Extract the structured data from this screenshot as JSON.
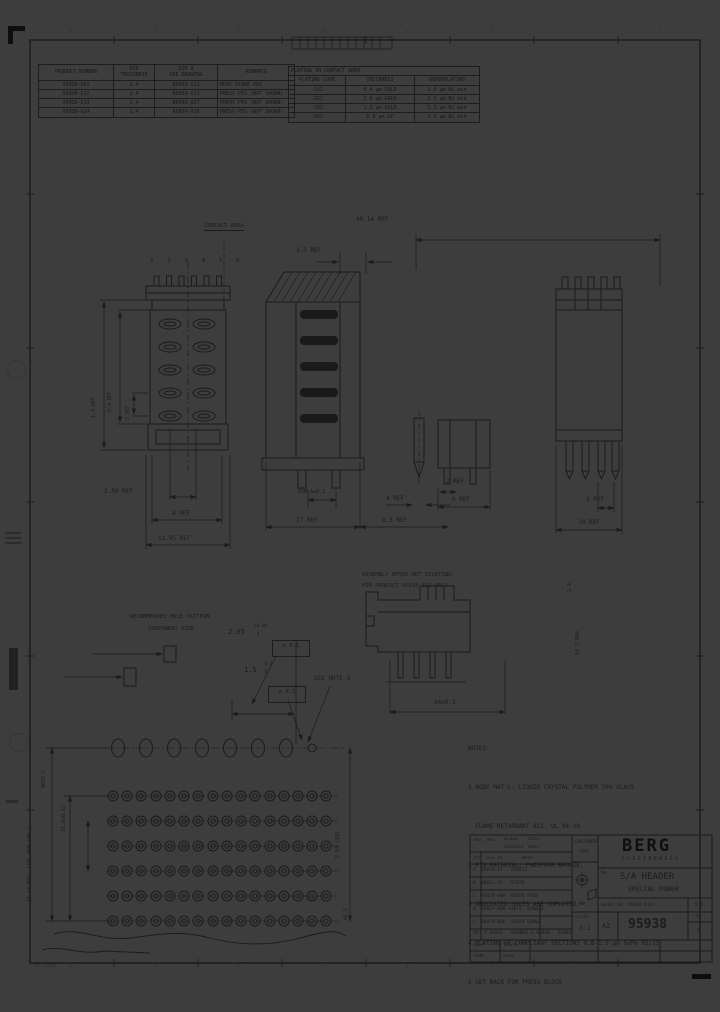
{
  "zones": [
    "8",
    "7",
    "6",
    "5",
    "4",
    "3",
    "2",
    "1"
  ],
  "tables": {
    "products": {
      "h1": "PRODUCT NUMBER",
      "h2a": "PCB",
      "h2b": "THICKNESS",
      "h3a": "DIM A",
      "h3b": "SEE DRAWING",
      "h4": "REMARKS",
      "rows": [
        {
          "pn": "95938-X02",
          "pcb": "2.4",
          "dim": "89039-X11",
          "remarks": "HEAT STAKE PEG"
        },
        {
          "pn": "95938-X12",
          "pcb": "2.4",
          "dim": "89039-X11",
          "remarks": "PRESS PEG (NOT SHOWN)"
        },
        {
          "pn": "95938-X13",
          "pcb": "2.4",
          "dim": "89039-X17",
          "remarks": "PRESS PEG (NOT SHOWN)"
        },
        {
          "pn": "95938-X14",
          "pcb": "2.4",
          "dim": "89039-X10",
          "remarks": "PRESS PEG (NOT SHOWN)"
        }
      ]
    },
    "plating": {
      "title": "PLATING IN CONTACT AREA",
      "headers": [
        "PLATING CODE",
        "THICKNESS",
        "UNDERPLATING"
      ],
      "rows": [
        {
          "code": "-1X2",
          "thickness": "0.4 µm GOLD",
          "under": "1.3 µm Ni min"
        },
        {
          "code": "-2X2",
          "thickness": "2.0 µm GOLD",
          "under": "1.3 µm Ni min"
        },
        {
          "code": "-3X2",
          "thickness": "1.3 µm GOLD",
          "under": "1.3 µm Ni min"
        },
        {
          "code": "-9X2",
          "thickness": "0.8 µm GF",
          "under": "1.3 µm Ni min"
        }
      ]
    }
  },
  "labels": {
    "contact_area": "CONTACT AREA",
    "pins": "1 2 3 4 5 6",
    "dim_4014": "40.14 REF",
    "dim_33": "3.3 REF",
    "fv_14": "1.4 REF",
    "fv_94": "9.4 REF",
    "fv_2": "2 REF",
    "fv_250": "2.50 REF",
    "fv_8": "8 REF",
    "fv_1195": "11.95 REF",
    "cv_dima": "DIM A±0.1",
    "cv_17": "17 REF",
    "cv_85": "8.5 REF",
    "cv_4": "4 REF",
    "cv_2": "2 REF",
    "cv_6": "6 REF",
    "rv_2": "2 REF",
    "rv_10": "10 REF",
    "asm1": "ASSEMBLY AFTER HOT RIVETING:",
    "asm2": "FOR PRODUCT 95938-X02 ONLY",
    "asm_34": "34±0.2",
    "asm_24": "2.4",
    "asm_145": "14.5 MAX",
    "hp1": "RECOMMENDED HOLE PATTERN,",
    "hp2": "COMPONENT SIDE.",
    "hp_205": "2.05",
    "hp_205t": "+0.05",
    "hp_205b": " 0",
    "hp_pos1": "⌀ 0.1",
    "hp_15": "1.5",
    "hp_15t": "-0.1",
    "hp_15b": " 0",
    "hp_pos2": "⌀ 0.1",
    "hp_note3": "SEE NOTE 3",
    "hp_note5": "NOTE 5",
    "hp_310": "31.0±0.15",
    "hp_1664": "16.64 REF. (TOL NON CUM.)",
    "hp_254": "2.54 (5X)",
    "hp_dia15": "⌀1.5",
    "corner_note": "WV-7968"
  },
  "notes": {
    "title": "NOTES:",
    "items": [
      "1 BODY MAT'L: LIQUID CRYSTAL POLYMER 30% GLASS",
      "  FLAME RETARDANT ACC. UL 94-V0",
      "2 PIN MATERIAL: PHOSPHOR BRONZE.",
      "3 INDICATED HOLES ARE UNPLATED.",
      "4 PLATING OF COMPLIANT SECTIONS 0.8-1.5 µm SnPb 85/15",
      "5 SET BACK FOR PRESS BLOCK"
    ]
  },
  "titleblock": {
    "header_left": "rev. nos.",
    "header_c1": "drawn    date",
    "header_c2": "checked  date",
    "cols": "ltr  eco no.      date",
    "revs": [
      "A  96019-97   920522",
      "B  96013-71   92078",
      "C  96029-008  93070 9708",
      "D  96037-008-93073  930823",
      "E  96074-006  93023 93902",
      "2M  2.95943   93902",
      "ECO 2.95940   93003"
    ],
    "customer1": "CUSTOMER",
    "customer2": "COPY",
    "units": "mm",
    "scale_label": "scale",
    "scale_value": "3:1",
    "brand": "BERG",
    "brand_sub": "ELECTRONICS",
    "no_label": "No.",
    "title1": "S/A HEADER",
    "title2": "SPECIAL POWER",
    "model_row": "model No. 95938-X(X)",
    "model_right": "3.0",
    "size": "A2",
    "number": "95938",
    "rev_label": "rev",
    "rev_value": "d",
    "strip_used": "used",
    "strip_trace": "trace",
    "strip_code": "code",
    "strip_used2": "used"
  }
}
